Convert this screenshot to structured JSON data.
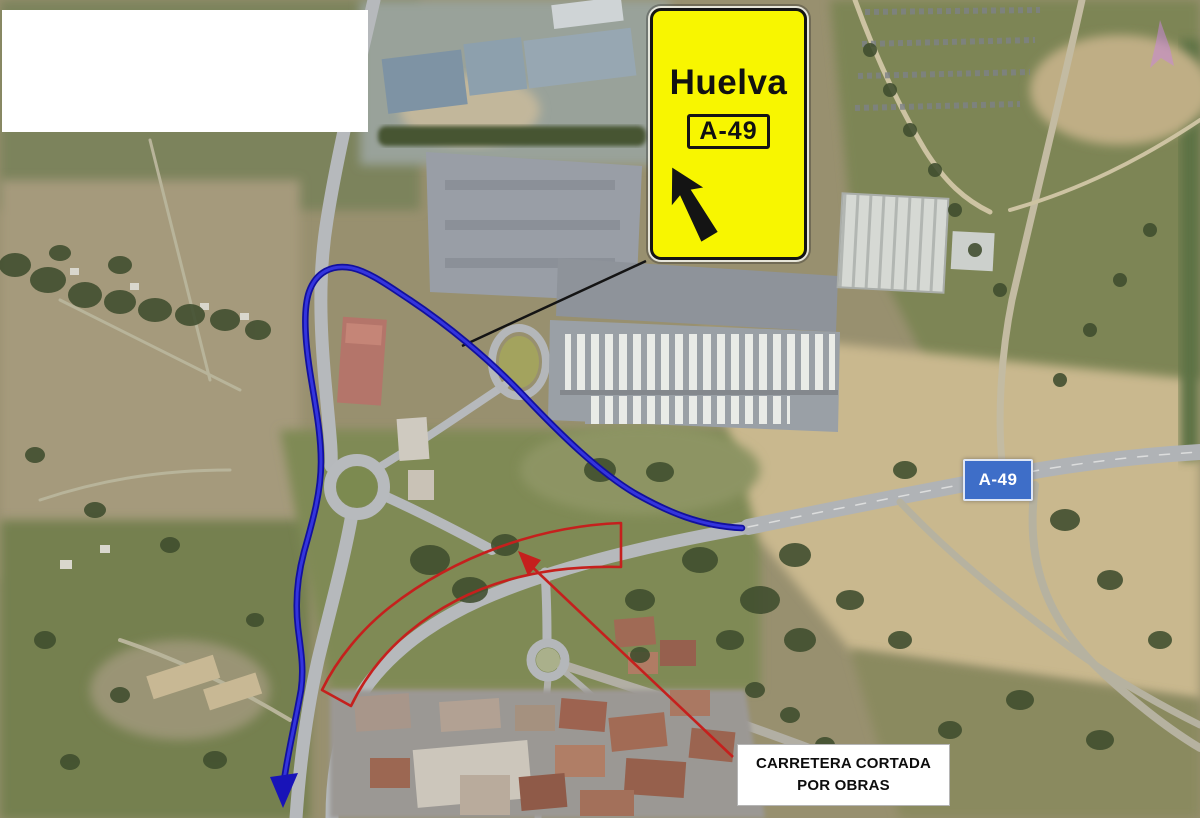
{
  "map": {
    "road_shield": {
      "label": "A-49",
      "bg_color": "#3e6ec8",
      "text_color": "#ffffff"
    }
  },
  "sign": {
    "destination": "Huelva",
    "route_badge": "A-49",
    "bg_color": "#f8f600",
    "text_color": "#111111",
    "arrow_icon": "arrow-up-left"
  },
  "route_overlay": {
    "color": "#1c18c8"
  },
  "closure_overlay": {
    "color": "#c5201d",
    "label_line1": "CARRETERA CORTADA",
    "label_line2": "POR OBRAS",
    "label_bg": "#ffffff",
    "label_text_color": "#0d0d0d"
  },
  "cursor": {
    "color": "#c887d8"
  }
}
